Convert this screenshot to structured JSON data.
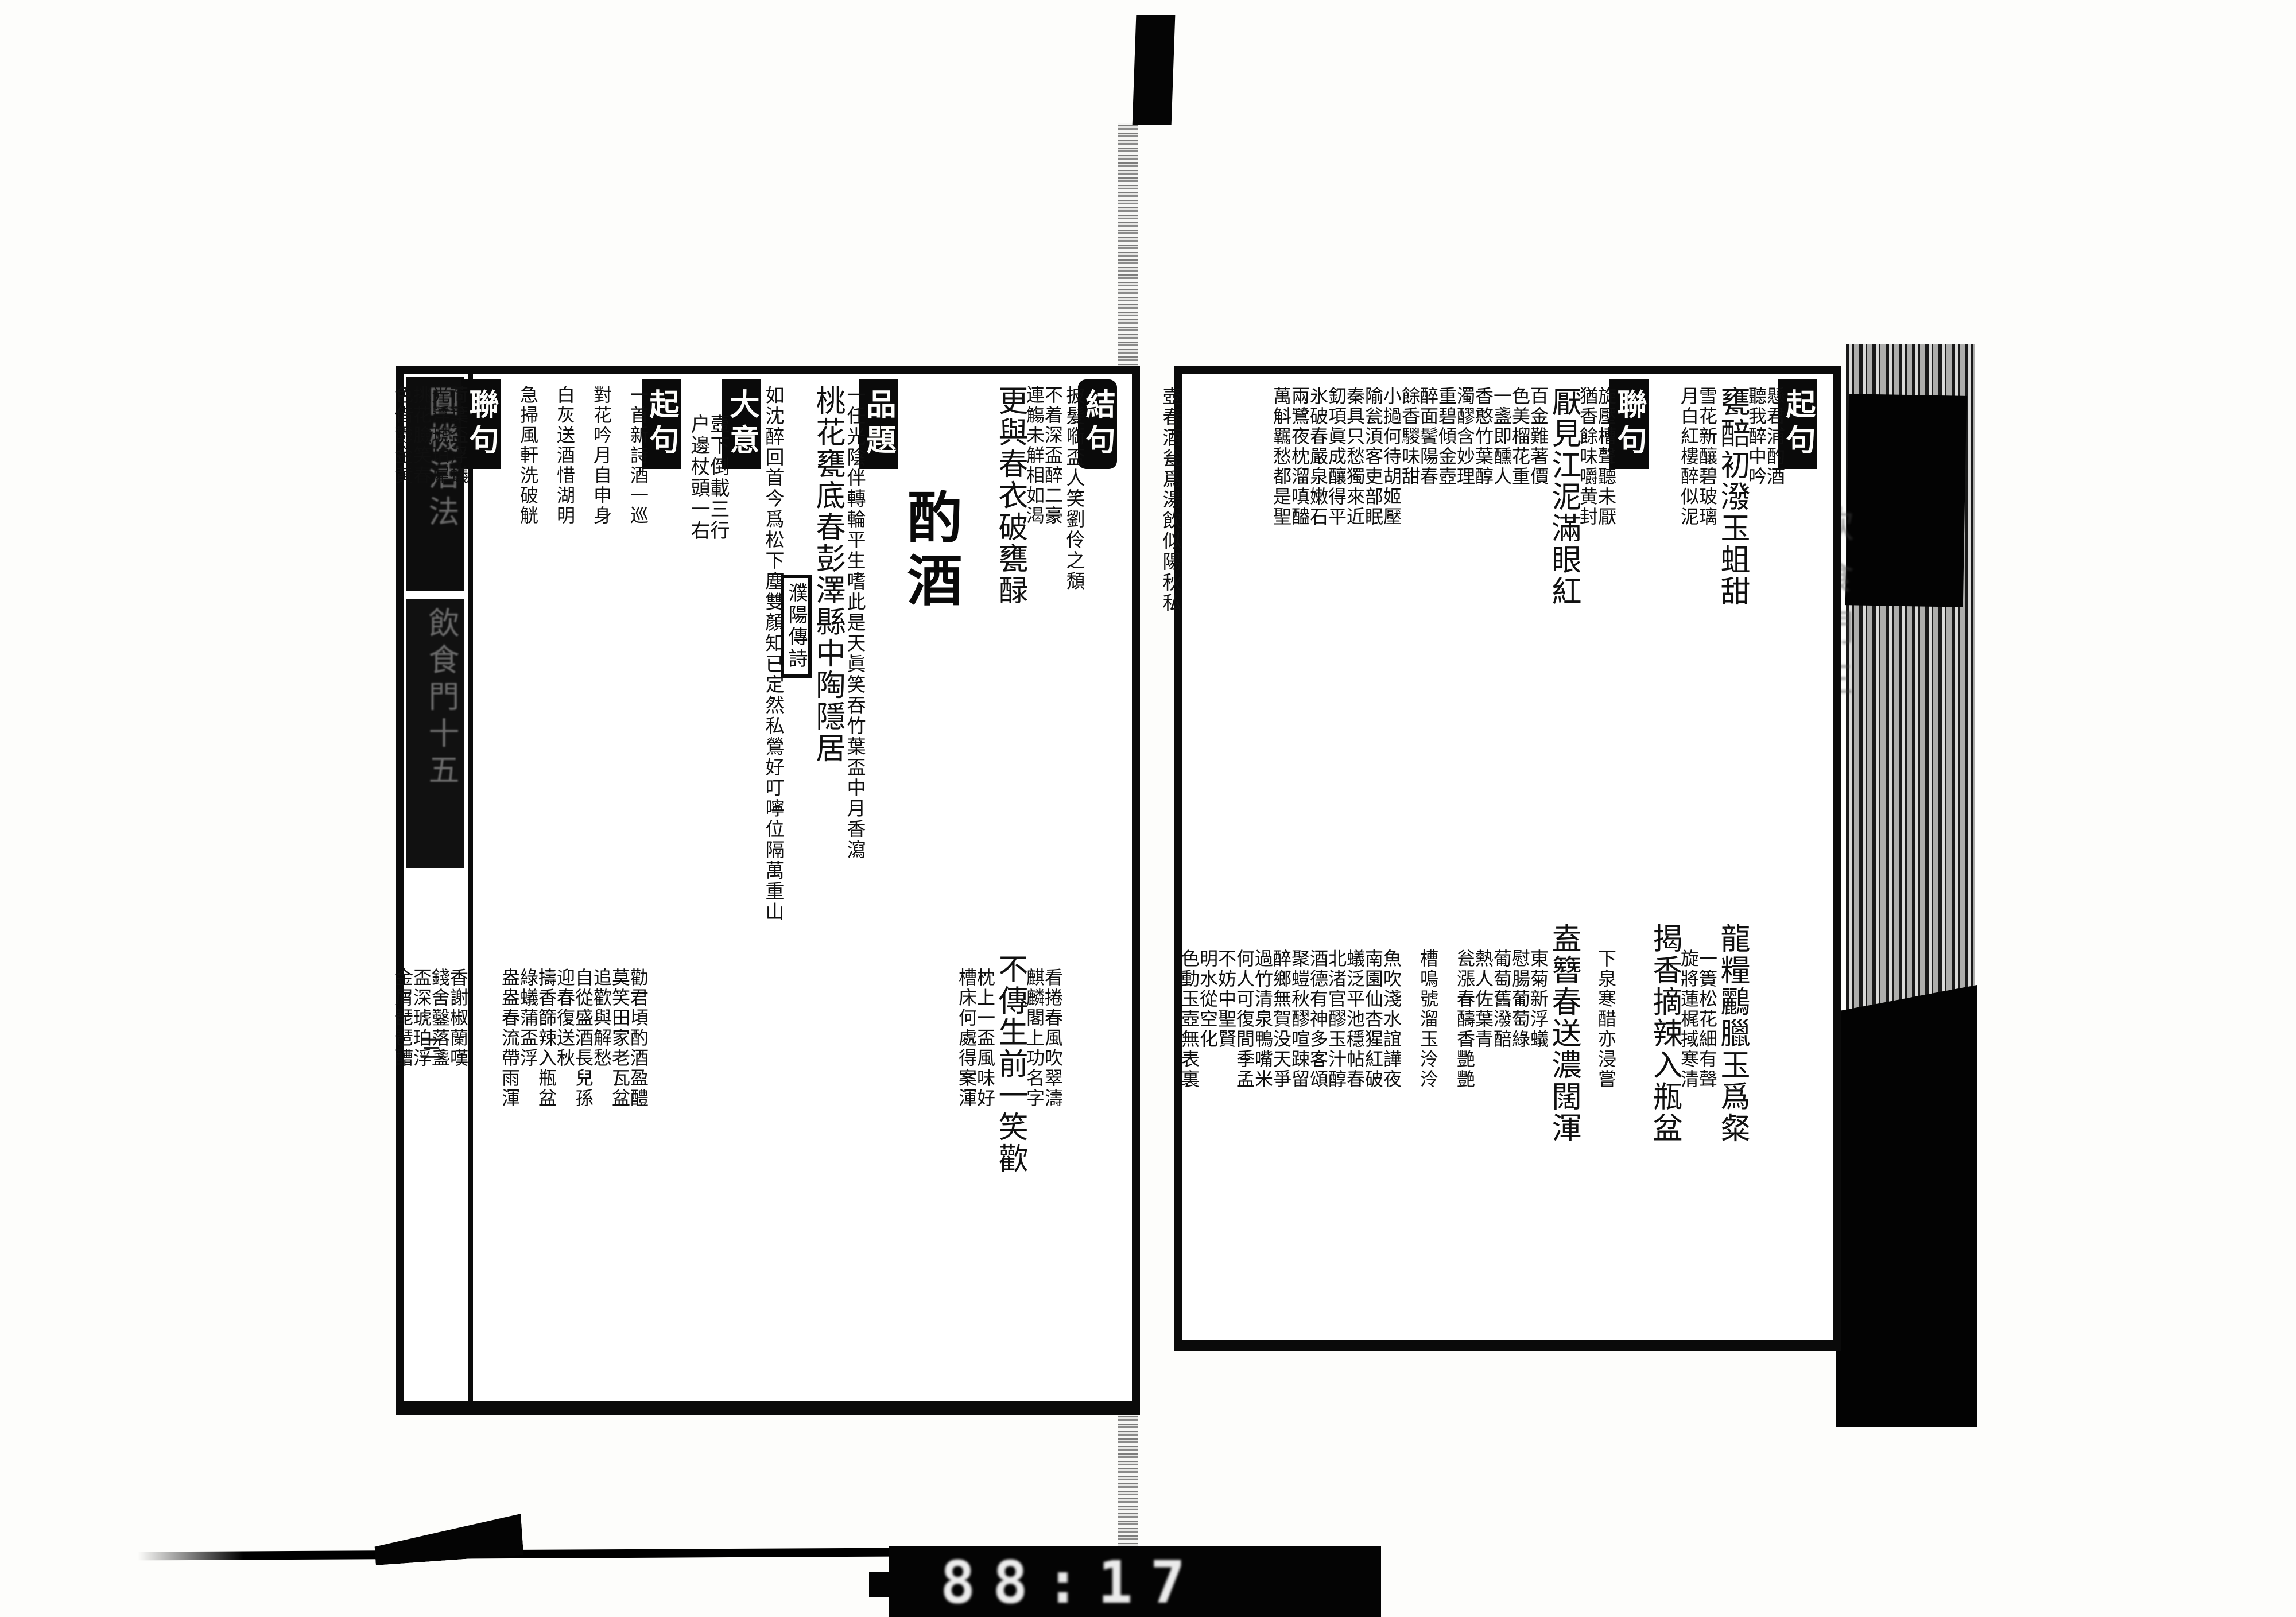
{
  "scan": {
    "counter_digits": "88:17",
    "spine": {
      "book_title": "圓機活法",
      "section_volume": "飲食門十五",
      "page_mark": "三"
    },
    "right_margin_text": "飲食門三",
    "ink_color": "#0b0b0b",
    "paper_color": "#ffffff"
  },
  "left_page": {
    "sections": [
      {
        "label": "結句",
        "rounded": true,
        "cols": [
          {
            "t": "披髮㗸盃人笑劉伶之頹",
            "small": true
          },
          {
            "u": "不着深盃醉二豪\n連觴未觧相如渴",
            "l": "看捲春風吹翠濤\n麒麟閣上功名字"
          },
          {
            "u": "更與春衣破甕醁",
            "l": "不傳生前一笑歡"
          },
          {
            "u": "",
            "l": "枕上一盃風味好\n槽床何處得案渾"
          }
        ]
      },
      {
        "title": "酌酒"
      },
      {
        "label": "品題",
        "cols": [
          {
            "t": "一任光陰伴轉輪平生嗜此是天眞笑吞竹葉盃中月香瀉",
            "small": true
          },
          {
            "u": "桃花甕底春彭澤縣中陶隱居",
            "l": ""
          },
          {
            "box": "濮陽傳詩"
          },
          {
            "t": "如沈醉回首今爲松下塵雙顏知已定然私鶯好叮嚀位隔萬重山",
            "small": true
          }
        ]
      },
      {
        "label": "大意",
        "notes": [
          "壼下倒載三行",
          "户邊杖頭一右"
        ]
      },
      {
        "label": "起句",
        "cols": [
          {
            "u": "一首新詩酒一巡",
            "l": "勸君頃酌酒盈醴\n莫笑田家老瓦盆"
          },
          {
            "u": "對花吟月自申身",
            "l": "追歡與解愁\n自從盛酒長兒孫"
          },
          {
            "u": "白灰送酒惜湖明",
            "l": "迎春復送秋\n擣香篩辣入瓶盆"
          },
          {
            "u": "急掃風軒洗破觥",
            "l": "綠蟻蒲盃浮\n盎盎春流帶雨渾"
          }
        ]
      },
      {
        "label": "聯句",
        "cols": [
          {
            "u": "荷葉盃浮蟻\n光浮琥珀犀",
            "l": "香謝椒蘭嘆\n錢舍鑿落盞"
          },
          {
            "u": "挑花臉笑春\n色借鬱金黄",
            "l": "盃深琥珀浮\n金屑琵琶醩"
          }
        ]
      }
    ]
  },
  "right_page": {
    "sections": [
      {
        "label": "起句",
        "cols": [
          {
            "u": "懸君浦酌酒\n聽我醉中吟",
            "l": ""
          },
          {
            "u": "甕醅初潑玉蛆甜",
            "l": "龍糧鸝臘玉爲粲"
          },
          {
            "u": "雪花新釀碧玻璃\n月白紅樓醉似泥",
            "l": "一簣松花細有聲\n旋將蓮梶掝寒清"
          },
          {
            "u": "",
            "l": "揭香摘辣入瓶盆"
          }
        ]
      },
      {
        "label": "聯句",
        "cols": [
          {
            "u": "旋壓槽聲聽未厭\n猶香餘味嚼黄封",
            "l": "下泉寒醋亦浸嘗"
          },
          {
            "u": "厭見江泥滿眼紅",
            "l": "盍簪春送濃闊渾"
          },
          {
            "u": "百金難著價\n色美榴花重",
            "l": "東菊新浮蟻\n慰腸葡萄綠"
          },
          {
            "u": "一盞即醺人\n香憨竹葉醇",
            "l": "葡萄舊潑醅\n熱人佐葉青"
          },
          {
            "u": "濁醪含妙理\n重碧傾金壺",
            "l": "瓮漲春醻香艷艷"
          },
          {
            "u": "醉面鬢陽春\n餘香騣味甜",
            "l": "槽鳴號溜玉泠泠"
          },
          {
            "u": "小撾何待胡姬壓\n隃瓮湏客吏部眠",
            "l": "魚吹淺水誼譁夜\n南園仙杏猩紅破"
          },
          {
            "u": "秦具只愁獨來近\n釖項眞成釀得平",
            "l": "蟻泛平池穩帖春\n北渚官醪玉汁醇"
          },
          {
            "u": "氷破春嚴泉嫩石\n兩鷺夜枕溜嗔醠",
            "l": "酒德有神多客頌\n聚螘秋醪喧踈留"
          },
          {
            "u": "萬斛羈愁都是聖",
            "l": "醉鄉無賀没天爭\n過竹清泉鴨嘴米"
          },
          {
            "u": "",
            "l": "何人可復間季孟\n不妨中聖賢"
          },
          {
            "u": "",
            "l": "明水從空化\n色動玉壺無表裏"
          },
          {
            "t": "壺春酒瓮爲湯飲似陽秋私",
            "small": true
          }
        ]
      }
    ]
  }
}
